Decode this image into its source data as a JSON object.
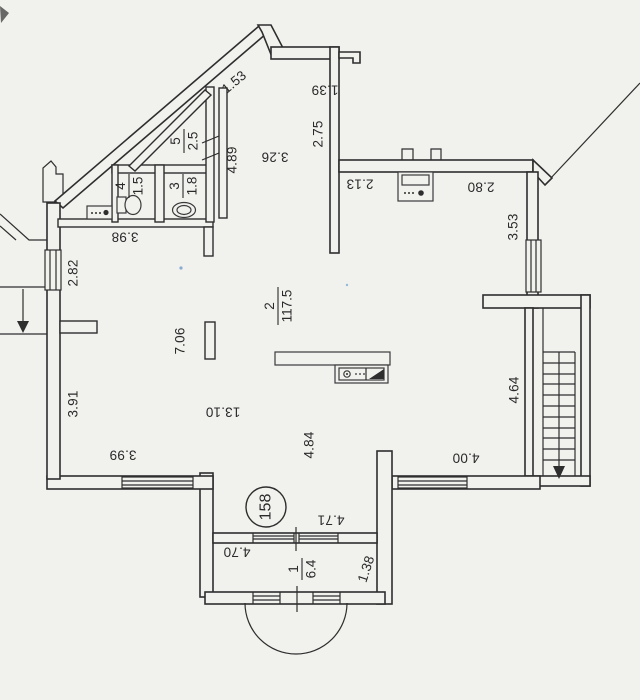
{
  "floor_plan": {
    "apartment_number": "158",
    "rooms": [
      {
        "number": "1",
        "area": "6.4"
      },
      {
        "number": "2",
        "area": "117.5"
      },
      {
        "number": "3",
        "area": "1.8"
      },
      {
        "number": "4",
        "area": "1.5"
      },
      {
        "number": "5",
        "area": "2.5"
      }
    ],
    "dimensions": [
      "1.53",
      "1.39",
      "2.75",
      "3.26",
      "4.89",
      "2.13",
      "2.80",
      "3.53",
      "3.98",
      "2.82",
      "7.06",
      "3.91",
      "13.10",
      "4.84",
      "4.64",
      "3.99",
      "4.00",
      "4.71",
      "4.70",
      "1.38"
    ],
    "colors": {
      "paper": "#f1f2ee",
      "ink": "#2e2e2e",
      "speckle_blue": "#5b8fc9"
    },
    "icons": [
      "toilet-icon",
      "bidet-icon",
      "electrical-panel-icon",
      "stove-icon",
      "kitchen-sink-icon",
      "stairs-down-arrow-icon",
      "balcony-bay-arc",
      "window-hatch",
      "chimney-outline"
    ]
  }
}
